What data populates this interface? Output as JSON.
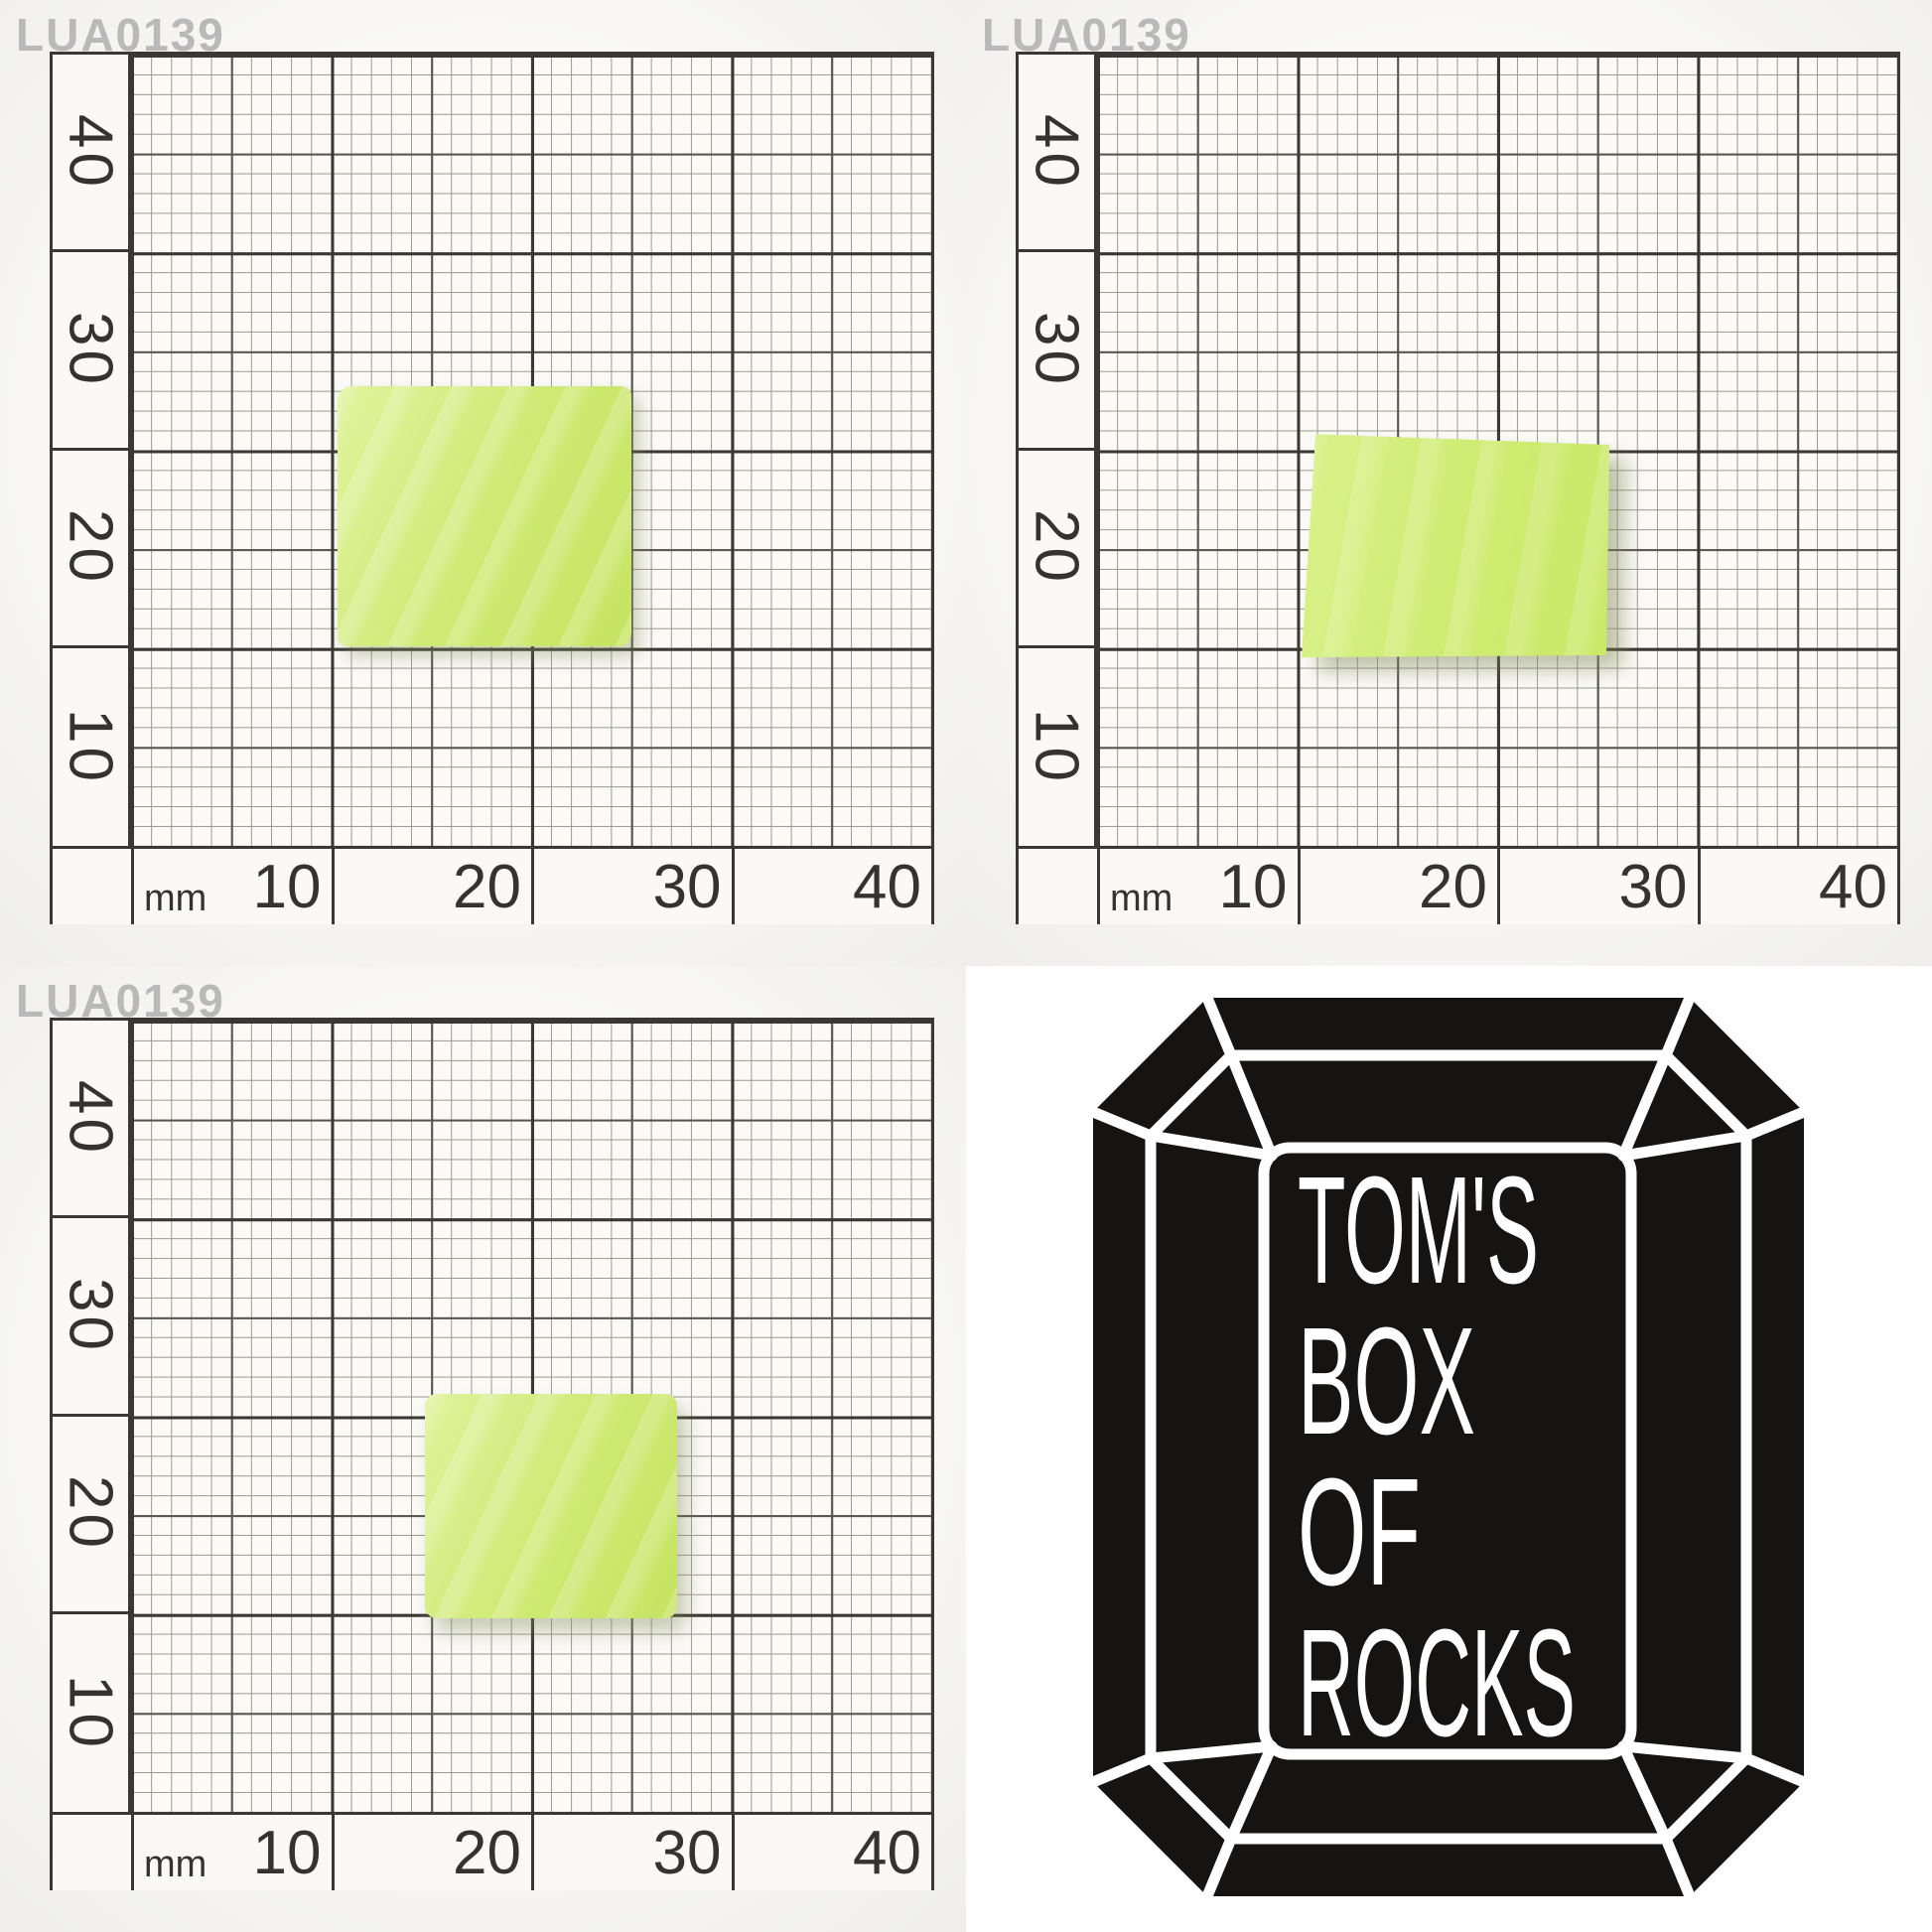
{
  "watermark": "LUA0139",
  "graph_paper": {
    "unit": "mm",
    "x_labels": [
      "10",
      "20",
      "30",
      "40"
    ],
    "y_labels": [
      "40",
      "30",
      "20",
      "10"
    ],
    "range_mm": 40,
    "line_colors": {
      "thick": "#3a3834",
      "medium": "#56544e",
      "thin": "#9b9890"
    }
  },
  "specimen": {
    "color_hex": "#cdea72",
    "description": "lime green rough slab",
    "panels": [
      {
        "panel": "top-left",
        "x_extent_mm": [
          10.3,
          25.0
        ],
        "y_extent_mm": [
          10.0,
          23.0
        ]
      },
      {
        "panel": "top-right",
        "x_extent_mm": [
          10.2,
          25.6
        ],
        "y_extent_mm": [
          9.5,
          20.9
        ]
      },
      {
        "panel": "bottom-left",
        "x_extent_mm": [
          14.7,
          27.3
        ],
        "y_extent_mm": [
          9.9,
          20.9
        ]
      }
    ]
  },
  "logo": {
    "shape": "emerald-cut-gem",
    "background_hex": "#161412",
    "line_hex": "#ffffff",
    "lines": [
      "TOM'S",
      "BOX",
      "OF",
      "ROCKS"
    ]
  }
}
